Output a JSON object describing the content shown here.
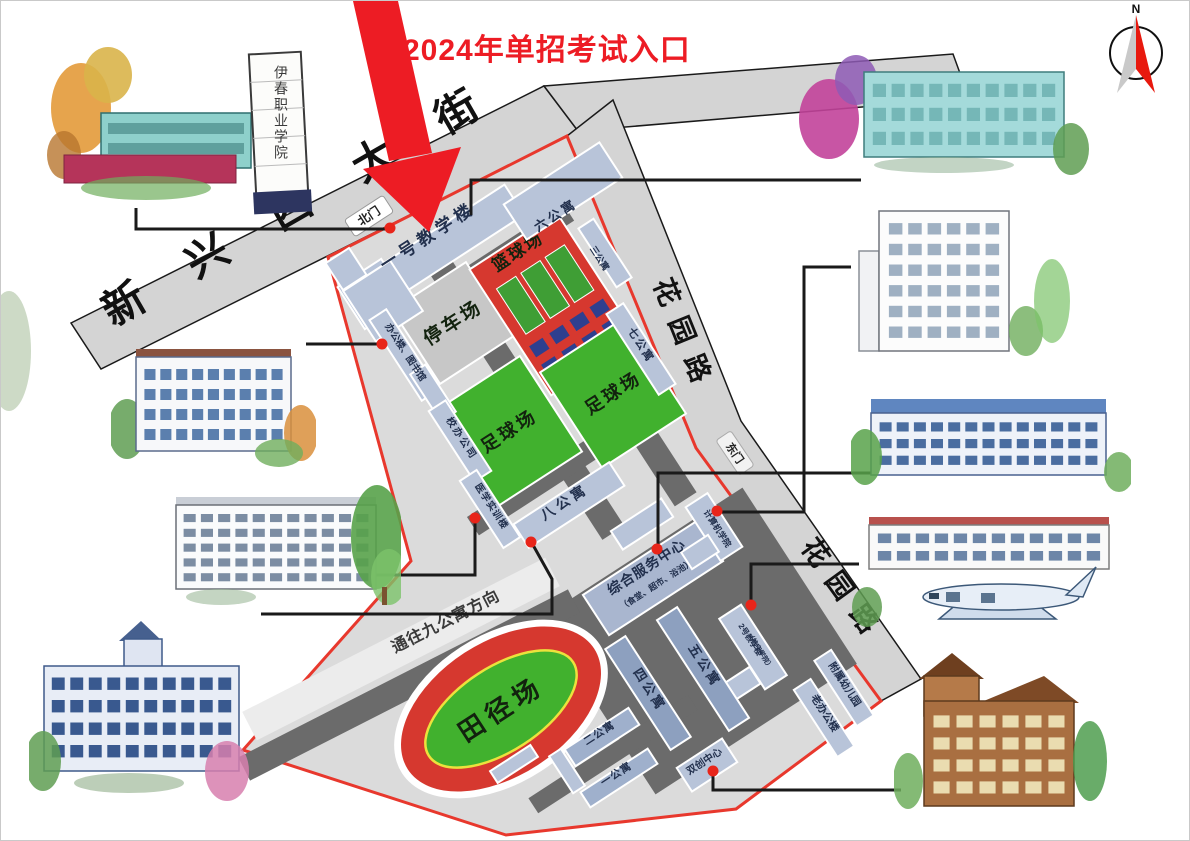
{
  "title": {
    "text": "2024年单招考试入口"
  },
  "compass": {
    "label": "N"
  },
  "roads": {
    "main_street": "新兴西大街",
    "garden_road_upper": "花园路",
    "garden_road_lower": "花园路",
    "to_apartment9": "通往九公寓方向"
  },
  "gates": {
    "north": "北门",
    "east": "东门"
  },
  "campus": {
    "buildings": {
      "teach1": "一号教学楼",
      "apt6": "六公寓",
      "apt3": "三公寓",
      "apt7": "七公寓",
      "apt8": "八公寓",
      "apt5": "五公寓",
      "apt4": "四公寓",
      "apt2": "二公寓",
      "apt1": "一公寓",
      "office_library": "办公楼、图书馆",
      "school_company": "校办公司",
      "medical_training": "医学实训楼",
      "computer_college": "计算机学院",
      "teach2": "2号教学楼",
      "teach2_sub": "（航空学院）",
      "service_center": "综合服务中心",
      "service_center_sub": "（食堂、超市、浴池）",
      "old_office": "老办公楼",
      "kindergarten": "附属幼儿园",
      "innovation_center": "双创中心"
    },
    "facilities": {
      "parking": "停车场",
      "basketball": "篮球场",
      "soccer_left": "足球场",
      "soccer_right": "足球场",
      "track": "田径场"
    }
  },
  "illustrations": {
    "gate_sign": "伊春职业学院"
  },
  "colors": {
    "accent_red": "#ed1c24",
    "boundary_red": "#e8382d",
    "field_green": "#41b12e",
    "court_red": "#d6382f",
    "road_dark": "#6b6b6b",
    "road_light": "#d4d4d4",
    "building_blue": "#b8c4d9"
  }
}
